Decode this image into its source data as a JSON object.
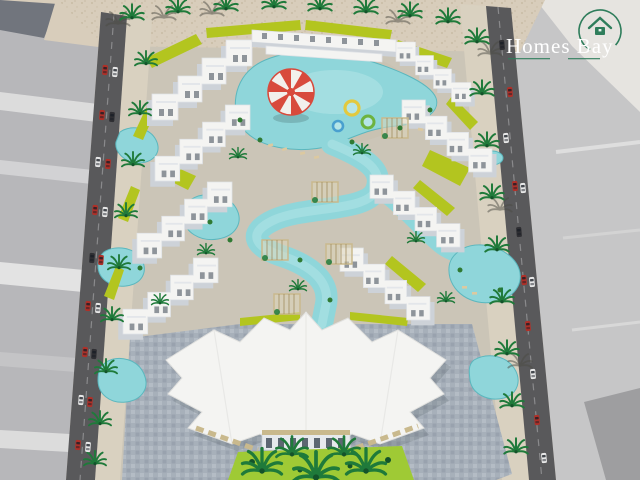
{
  "logo": {
    "text": "Homes Bay",
    "icon": "house-in-circle-icon"
  },
  "palette": {
    "sand": "#d8cdbb",
    "ground": "#cbc5b7",
    "sidewalk": "#d9d1c0",
    "plot_gray_light": "#c6c6c7",
    "plot_gray_mid": "#b7b7ba",
    "plot_gray_dark": "#71757d",
    "plot_white_band": "#e0e0e0",
    "road": "#59595b",
    "road_line": "#8a8a8c",
    "pool": "#8fd6da",
    "pool_light": "#b5e5e7",
    "pool_edge": "#5bb7be",
    "lime_green": "#b3c51f",
    "lawn_green": "#9fca35",
    "palm_green": "#1f7a3a",
    "palm_dark": "#14532a",
    "building_white": "#f4f4f2",
    "building_shade": "#cdd2d8",
    "window_dark": "#3c4754",
    "awning_tan": "#c9b98d",
    "plaza_stone": "#a7b0ba",
    "plaza_dark": "#8d97a3",
    "parasol_red": "#d84a3c",
    "parasol_white": "#f2f0ec",
    "car_red": "#b03028",
    "car_white": "#e9e9e9",
    "car_dark": "#2f2f33",
    "logo_green": "#2e7d5b",
    "logo_text": "#ffffff"
  },
  "scene": {
    "features": [
      "perimeter-road-left",
      "perimeter-road-right",
      "cars",
      "palm-trees",
      "sand-ground",
      "neighboring-gray-plots",
      "zigzag-apartment-clusters",
      "winding-lagoon-pool",
      "kids-pool-with-red-white-parasol",
      "pool-floats",
      "pergola-cabanas",
      "lime-green-landscaping",
      "clubhouse-building",
      "cobblestone-plaza",
      "front-lawn-garden",
      "homes-bay-logo"
    ]
  }
}
